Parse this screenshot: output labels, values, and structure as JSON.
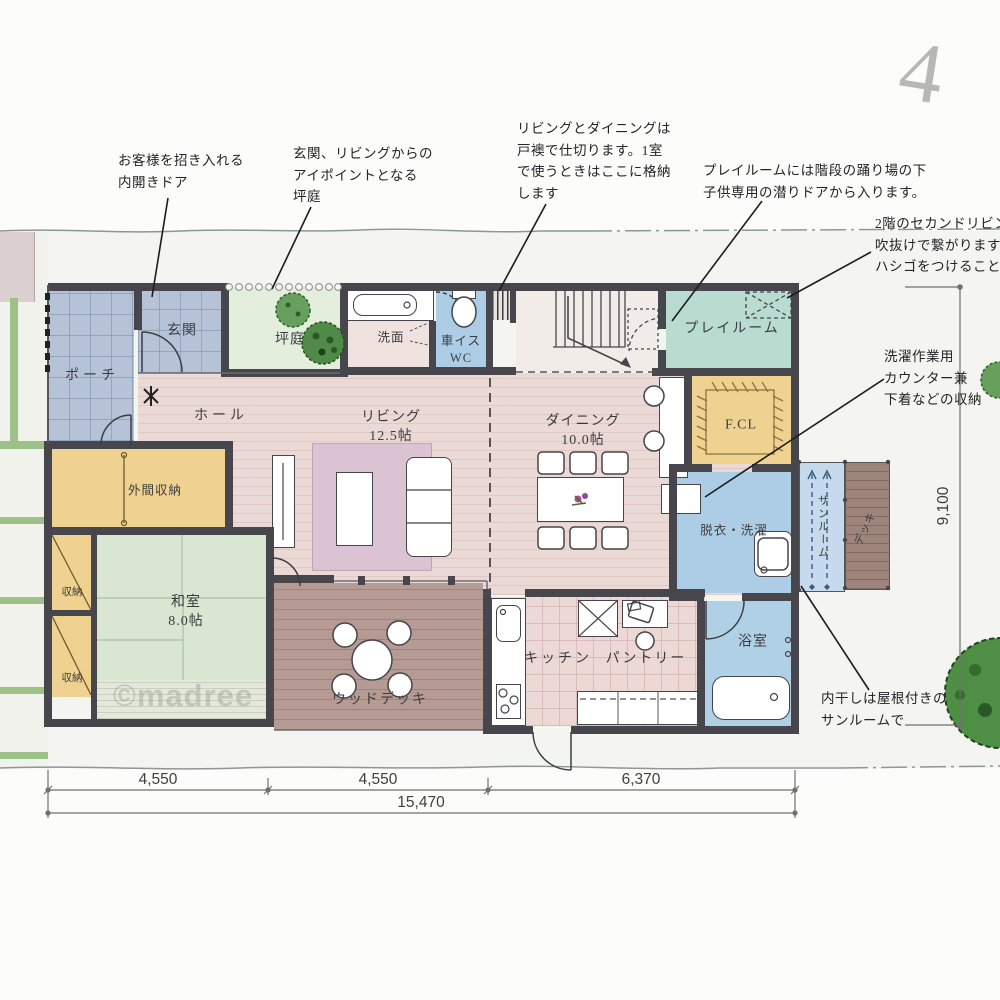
{
  "site": {
    "watermark": "©madree",
    "pencil_mark": "4"
  },
  "rooms": {
    "porch": {
      "label": "ポーチ"
    },
    "genkan": {
      "label": "玄関"
    },
    "tsuboniwa": {
      "label": "坪庭"
    },
    "hall": {
      "label": "ホール"
    },
    "senmen": {
      "label": "洗面"
    },
    "wc": {
      "label": "車イス\nWC"
    },
    "living": {
      "label": "リビング\n12.5帖"
    },
    "dining": {
      "label": "ダイニング\n10.0帖"
    },
    "playroom": {
      "label": "プレイルーム"
    },
    "fcl": {
      "label": "F.CL"
    },
    "datsui": {
      "label": "脱衣・洗濯"
    },
    "sunroom": {
      "label": "サンルーム"
    },
    "side_deck": {
      "label": "デッキ"
    },
    "bath": {
      "label": "浴室"
    },
    "kitchen": {
      "label": "キッチン"
    },
    "pantry": {
      "label": "パントリー"
    },
    "washitsu": {
      "label": "和室\n8.0帖"
    },
    "doma_storage": {
      "label": "外間収納"
    },
    "storage_a": {
      "label": "収納"
    },
    "storage_b": {
      "label": "収納"
    },
    "wood_deck": {
      "label": "ウッドデッキ"
    }
  },
  "annotations": {
    "entry_door": {
      "text": "お客様を招き入れる\n内開きドア"
    },
    "courtyard": {
      "text": "玄関、リビングからの\nアイポイントとなる\n坪庭"
    },
    "partition": {
      "text": "リビングとダイニングは\n戸襖で仕切ります。1室\nで使うときはここに格納\nします"
    },
    "playroom_door": {
      "text": "プレイルームには階段の踊り場の下\n子供専用の潜りドアから入ります。"
    },
    "second_living": {
      "text": "2階のセカンドリビン\n吹抜けで繋がります。\nハシゴをつけることも"
    },
    "laundry_counter": {
      "text": "洗濯作業用\nカウンター兼\n下着などの収納"
    },
    "indoor_drying": {
      "text": "内干しは屋根付きの\nサンルームで"
    }
  },
  "dimensions": {
    "width_left": "4,550",
    "width_mid": "4,550",
    "width_right": "6,370",
    "width_total": "15,470",
    "depth": "9,100"
  }
}
